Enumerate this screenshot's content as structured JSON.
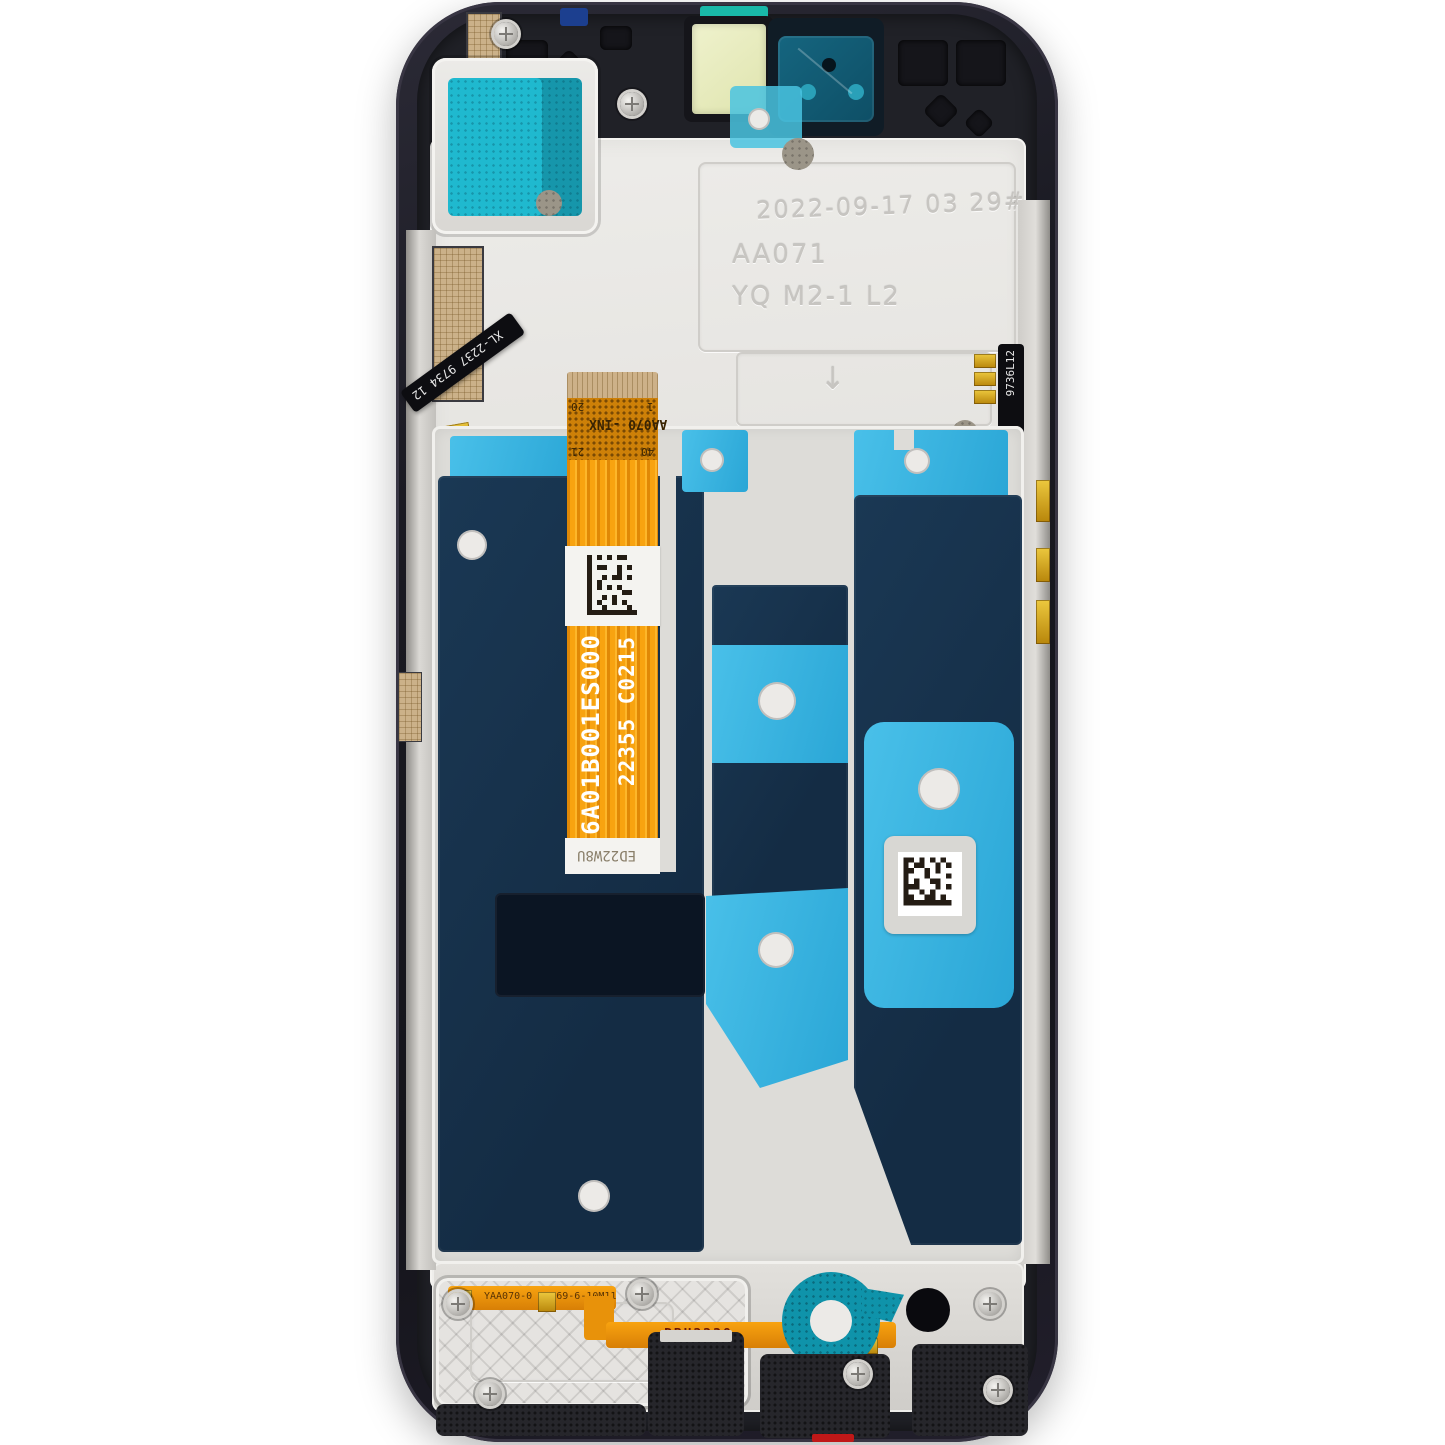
{
  "photo": {
    "subject": "smartphone LCD display assembly with frame, rear view",
    "background": "#ffffff"
  },
  "colors": {
    "frame_dark": "#1b1b22",
    "midplate_silver": "#e3e1dd",
    "graphite_navy": "#16304a",
    "adhesive_cyan": "#35b4e2",
    "teal_adhesive": "#1fb9cf",
    "flex_orange": "#f59d0e",
    "label_white": "#f4f3f0",
    "gold_contact": "#d4a52a",
    "red_gasket": "#c01818"
  },
  "engraving": {
    "date_code": "2022-09-17 03 29#",
    "unit_code": "AA071",
    "model_code": "YQ M2-1 L2",
    "arrow_mark": "↓"
  },
  "main_flex": {
    "connector_label": "AA070 -INX",
    "pins": {
      "p1": "1",
      "p20": "20",
      "p21": "21",
      "p40": "40"
    },
    "part_number": "6A01B001ES000",
    "lot_code": "22355 C0215",
    "bottom_label": "ED22W8U"
  },
  "side_flex": {
    "left_code": "XL-2237 9734 12",
    "right_code": "9736L12",
    "right_code2": "C M14"
  },
  "bottom_flex": {
    "code1": "YAA070-0 97369-6-10M11",
    "code2": "PBH2238"
  }
}
